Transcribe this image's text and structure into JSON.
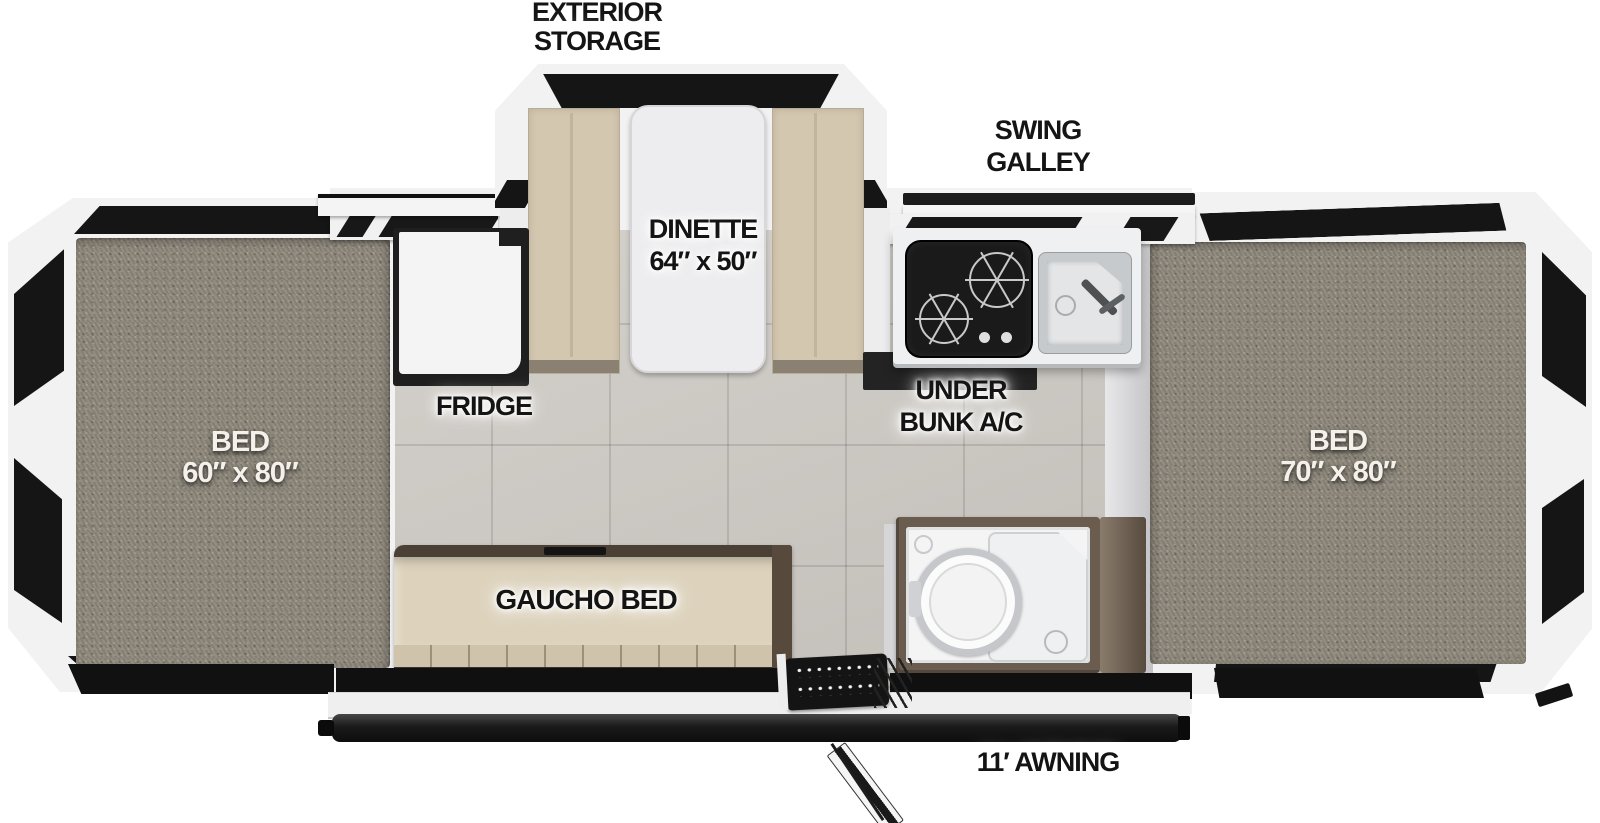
{
  "title": "Pop-up camper floor plan",
  "labels": {
    "exterior_storage": {
      "line1": "EXTERIOR",
      "line2": "STORAGE"
    },
    "swing_galley": {
      "line1": "SWING",
      "line2": "GALLEY"
    },
    "dinette": {
      "line1": "DINETTE",
      "line2": "64″ x 50″"
    },
    "fridge": {
      "text": "FRIDGE"
    },
    "under_bunk_ac": {
      "line1": "UNDER",
      "line2": "BUNK A/C"
    },
    "bed_left": {
      "line1": "BED",
      "line2": "60″ x 80″"
    },
    "bed_right": {
      "line1": "BED",
      "line2": "70″ x 80″"
    },
    "gaucho_bed": {
      "text": "GAUCHO BED"
    },
    "awning": {
      "text": "11′ AWNING"
    }
  },
  "colors": {
    "background": "#ffffff",
    "frame_white": "#f2f2f3",
    "accent_black": "#151515",
    "carpet_gray": "#8d877a",
    "floor_tile": "#cdc9c3",
    "cushion_beige": "#d4c7b0",
    "gaucho_beige": "#ddd3bd",
    "wood_brown": "#6a5d4f",
    "counter_white": "#eef0f1"
  }
}
